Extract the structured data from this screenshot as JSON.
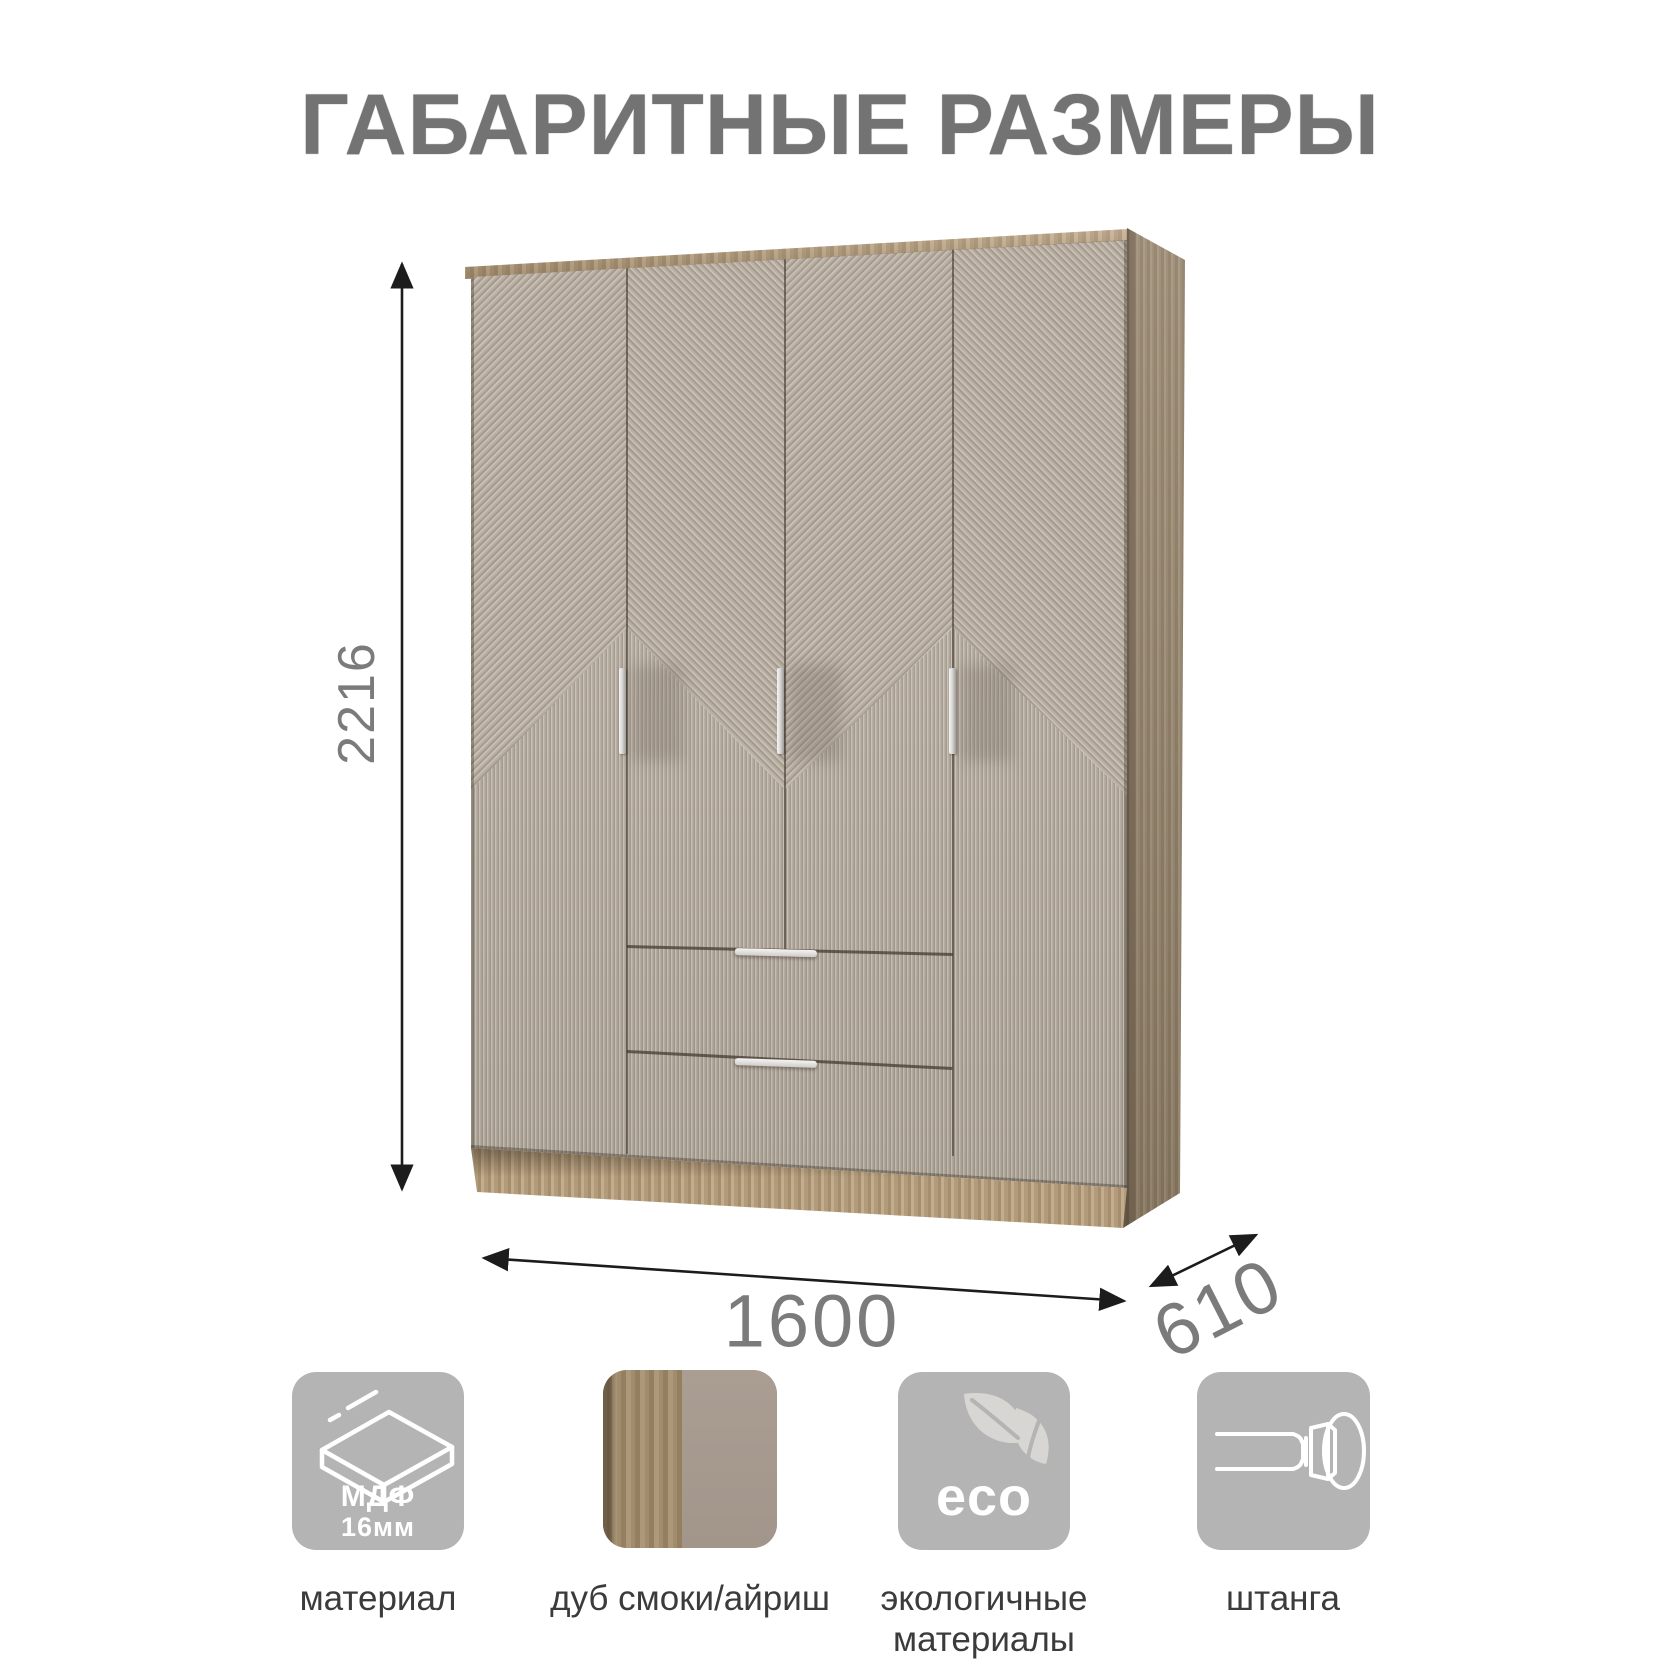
{
  "title": "ГАБАРИТНЫЕ РАЗМЕРЫ",
  "dimensions": {
    "height": "2216",
    "width": "1600",
    "depth": "610"
  },
  "features": [
    {
      "id": "material",
      "icon": "mdf-board-icon",
      "icon_text_line1": "МДФ",
      "icon_text_line2": "16мм",
      "label": "материал"
    },
    {
      "id": "color",
      "icon": "wood-color-swatch",
      "label": "дуб смоки/айриш"
    },
    {
      "id": "eco",
      "icon": "eco-leaves-icon",
      "icon_text": "eco",
      "label_line1": "экологичные",
      "label_line2": "материалы"
    },
    {
      "id": "rod",
      "icon": "hanging-rod-icon",
      "label": "штанга"
    }
  ],
  "colors": {
    "door_front": "#beb4a8",
    "wood": "#b29a7b",
    "tile_background": "#b4b4b4",
    "label_text": "#3b3b3b",
    "dimension_text": "#7b7b7b",
    "title_text": "#737373",
    "arrow": "#1c1c1c"
  }
}
